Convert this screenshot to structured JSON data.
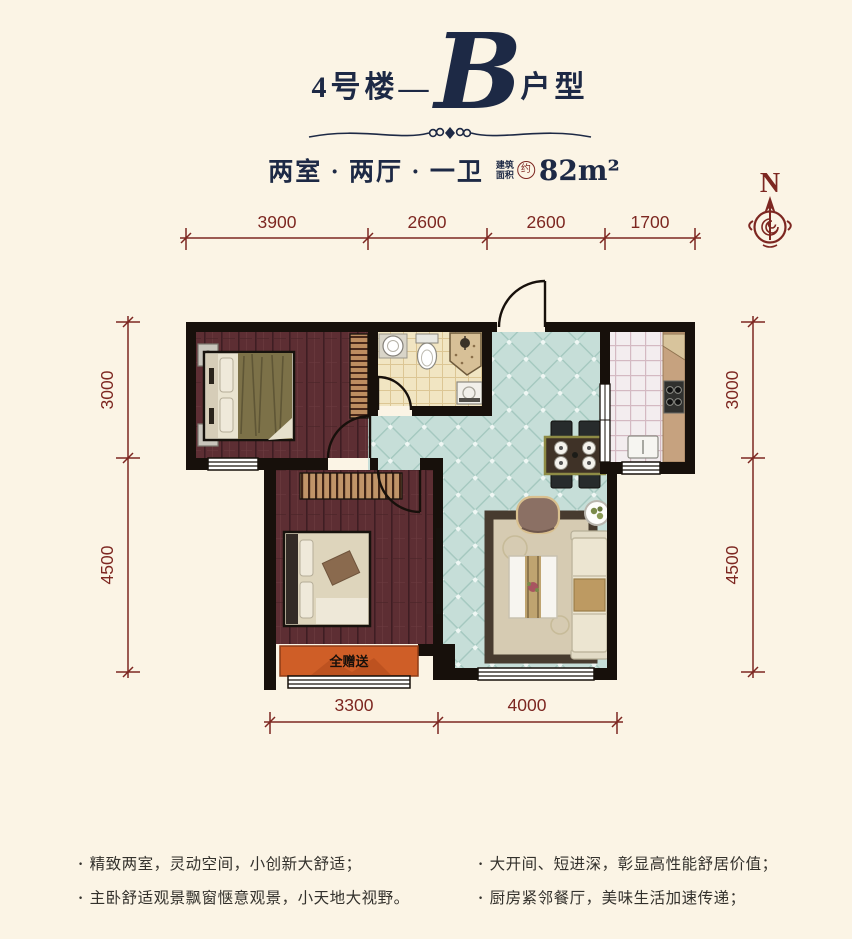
{
  "page": {
    "background": "#fbf4e5",
    "accent_maroon": "#7d2721",
    "navy": "#1d2945",
    "wall_color": "#17100b",
    "gift_orange": "#cf5e27",
    "teal_tile": "#c6ded8",
    "wood_floor": "#5d2e33"
  },
  "title": {
    "prefix": "4号楼",
    "dash": "—",
    "letter": "B",
    "suffix": "户型"
  },
  "subtitle": {
    "rooms": "两室 · 两厅 · 一卫",
    "area_label_top": "建筑",
    "area_label_bottom": "面积",
    "approx": "约",
    "area": "82m²"
  },
  "compass": {
    "north": "N"
  },
  "dimensions": {
    "top": [
      "3900",
      "2600",
      "2600",
      "1700"
    ],
    "left": [
      "3000",
      "4500"
    ],
    "right": [
      "3000",
      "4500"
    ],
    "bottom": [
      "3300",
      "4000"
    ]
  },
  "plan": {
    "gift_label": "全赠送"
  },
  "features": {
    "left": [
      "精致两室，灵动空间，小创新大舒适；",
      "主卧舒适观景飘窗惬意观景，小天地大视野。"
    ],
    "right": [
      "大开间、短进深，彰显高性能舒居价值；",
      "厨房紧邻餐厅，美味生活加速传递；"
    ]
  }
}
